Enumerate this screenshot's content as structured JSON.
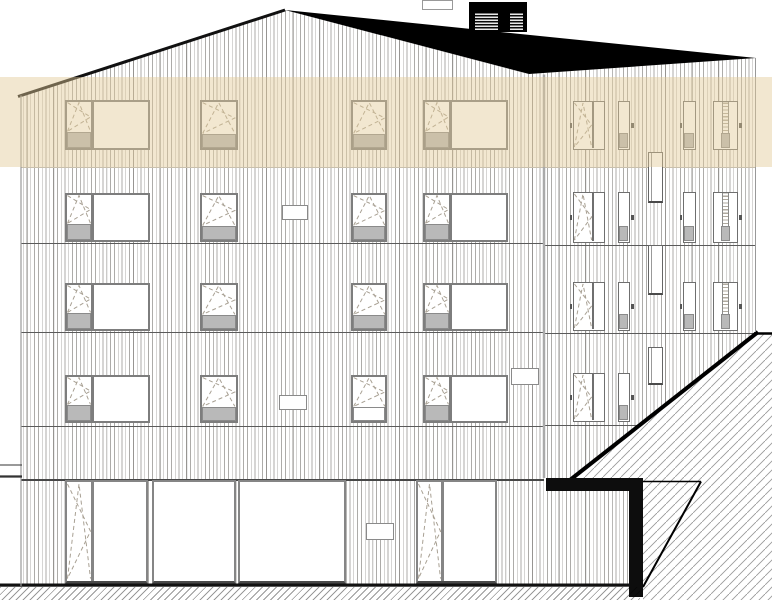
{
  "meta": {
    "type": "architectural-elevation",
    "width": 772,
    "height": 600
  },
  "colors": {
    "background": "#ffffff",
    "siding_line": "rgba(50,46,40,0.40)",
    "siding_line_bold": "rgba(50,46,40,0.18)",
    "floor_line": "#5a5a5a",
    "lintel_line": "#474747",
    "band_edge": "#c9c0ad",
    "frame": "#7d7d7d",
    "frame_narrow": "#6f6f6f",
    "frame_ground": "#858585",
    "frame_dark": "#4a4a4a",
    "panel_grey": "#b9b9b9",
    "panel_white": "#ffffff",
    "panel_border": "#8a8a8a",
    "glass": "#ffffff",
    "dash": "#a8a093",
    "roof_black": "#000000",
    "louver_light": "#e8e8e8",
    "hatch_line": "#9a9a9a",
    "ground_hatch_line": "rgba(0,0,0,0.40)",
    "highlight": "rgba(226,201,150,0.45)",
    "corner_line": "#aaaaaa",
    "edge_line": "#999999",
    "tick": "#555555",
    "vent_border": "#8a8a8a",
    "duct_border": "#666666",
    "dotted_pane": "rgba(110,100,80,0.55)"
  },
  "facade": {
    "clip": [
      [
        21,
        95.5
      ],
      [
        285,
        10
      ],
      [
        529,
        74
      ],
      [
        756,
        58
      ],
      [
        756,
        586
      ],
      [
        21,
        586
      ]
    ],
    "left_edge": {
      "x": 21,
      "y0": 95.5,
      "y1": 586
    },
    "corner": {
      "x": 544,
      "y0": 74.5,
      "y1": 478
    },
    "right_edge": {
      "x": 755.5,
      "y0": 58,
      "y1": 332
    },
    "band_edge_line": {
      "y": 167,
      "x0": 21,
      "x1": 756
    },
    "floor_lines_left": [
      {
        "y": 243,
        "t": 1.1
      },
      {
        "y": 332,
        "t": 1.1
      },
      {
        "y": 426,
        "t": 1.1
      },
      {
        "y": 479,
        "t": 1.6,
        "dark": true
      }
    ],
    "floor_lines_right": [
      {
        "y": 245,
        "t": 1.1
      },
      {
        "y": 333,
        "t": 1.1
      },
      {
        "y": 425,
        "t": 1.1
      }
    ],
    "left_span": {
      "x0": 21,
      "x1": 544
    },
    "right_span": {
      "x0": 544,
      "x1": 756
    }
  },
  "highlight_band": {
    "x": 0,
    "y": 77,
    "w": 772,
    "h": 90
  },
  "roof": {
    "polygon": [
      [
        285,
        10
      ],
      [
        756,
        58
      ],
      [
        529,
        74
      ]
    ],
    "gable_line": [
      [
        18,
        96.5
      ],
      [
        285,
        10
      ]
    ],
    "chimney": {
      "x": 469,
      "y": 2,
      "w": 58,
      "h": 30,
      "louvers": [
        {
          "x": 475,
          "y": 13,
          "w": 23,
          "h": 17
        },
        {
          "x": 510,
          "y": 13,
          "w": 13,
          "h": 17
        }
      ]
    },
    "vent_box": {
      "x": 422,
      "y": 0,
      "w": 31,
      "h": 10
    }
  },
  "windows": {
    "left_rows": [
      {
        "y": 100,
        "h": 50
      },
      {
        "y": 193,
        "h": 49
      },
      {
        "y": 283,
        "h": 48
      },
      {
        "y": 375,
        "h": 48
      }
    ],
    "wide_columns": {
      "xs": [
        65,
        423
      ],
      "w": 85,
      "sash_w": 24
    },
    "single_columns": [
      {
        "x": 200,
        "w": 37.5
      },
      {
        "x": 350.5,
        "w": 36.5
      }
    ],
    "single_white_panel": [
      {
        "row": 3,
        "col": 1
      }
    ],
    "right_rows": [
      {
        "y": 101,
        "h": 49
      },
      {
        "y": 192,
        "h": 51
      },
      {
        "y": 282,
        "h": 49
      },
      {
        "y": 373,
        "h": 49
      }
    ],
    "right_units": [
      {
        "x": 573,
        "w": 32,
        "type": "double",
        "tick": "left",
        "rows": [
          0,
          1,
          2,
          3
        ]
      },
      {
        "x": 617.5,
        "w": 12.5,
        "type": "narrow",
        "tick": "right",
        "rows": [
          0,
          1,
          2,
          3
        ]
      },
      {
        "x": 683,
        "w": 12.5,
        "type": "narrow",
        "tick": "left",
        "rows": [
          0,
          1,
          2
        ]
      },
      {
        "x": 713,
        "w": 25,
        "type": "composite",
        "tick": "right",
        "rows": [
          0,
          1,
          2
        ]
      }
    ],
    "ground": {
      "y": 480,
      "h": 104,
      "items": [
        {
          "x": 65,
          "w": 83,
          "type": "door_wide",
          "door_w": 24
        },
        {
          "x": 151.5,
          "w": 84,
          "type": "fixed"
        },
        {
          "x": 238,
          "w": 108,
          "type": "fixed"
        },
        {
          "x": 416,
          "w": 81,
          "type": "door_wide",
          "door_w": 23
        }
      ]
    }
  },
  "vents": [
    {
      "x": 282,
      "y": 205,
      "w": 26,
      "h": 15
    },
    {
      "x": 279,
      "y": 395,
      "w": 28,
      "h": 15
    },
    {
      "x": 511,
      "y": 368,
      "w": 28,
      "h": 17
    },
    {
      "x": 366,
      "y": 523,
      "w": 28,
      "h": 17
    }
  ],
  "ducts": [
    {
      "x": 647.5,
      "y": 152,
      "w": 15.5,
      "h": 51
    },
    {
      "x": 647.5,
      "y": 245,
      "w": 15.5,
      "h": 50
    },
    {
      "x": 647.5,
      "y": 347,
      "w": 15.5,
      "h": 38
    }
  ],
  "site": {
    "hatch_region": [
      [
        572,
        478
      ],
      [
        758,
        333
      ],
      [
        772,
        333
      ],
      [
        772,
        600
      ],
      [
        643,
        600
      ],
      [
        643,
        481
      ],
      [
        640,
        481
      ],
      [
        640,
        478
      ]
    ],
    "hatch_spacing": 9,
    "diagonal_edge": {
      "x1": 570,
      "y1": 480,
      "x2": 758,
      "y2": 332,
      "t": 4
    },
    "top_edge_line": {
      "x1": 754,
      "y1": 333.5,
      "x2": 772,
      "y2": 333.5,
      "t": 2.5
    },
    "beam": {
      "x": 546,
      "y": 478,
      "w": 94,
      "h": 13
    },
    "post": {
      "x": 629,
      "y": 478,
      "w": 14,
      "h": 119
    },
    "triangle_top": {
      "x1": 643,
      "y1": 481.5,
      "x2": 701,
      "y2": 481.5,
      "t": 1.5
    },
    "triangle_hyp": {
      "x1": 701,
      "y1": 481.5,
      "x2": 643,
      "y2": 587,
      "t": 2
    },
    "ground_line": {
      "x": 0,
      "y": 583.5,
      "w": 630,
      "h": 3.2
    },
    "ground_hatch": {
      "x": 0,
      "y": 587,
      "w": 640,
      "h": 13,
      "spacing": 5
    },
    "left_step_lines": [
      {
        "x1": 0,
        "y1": 465,
        "x2": 22,
        "y2": 465,
        "t": 1
      },
      {
        "x1": 0,
        "y1": 476.5,
        "x2": 22,
        "y2": 476.5,
        "t": 2.2
      }
    ]
  }
}
